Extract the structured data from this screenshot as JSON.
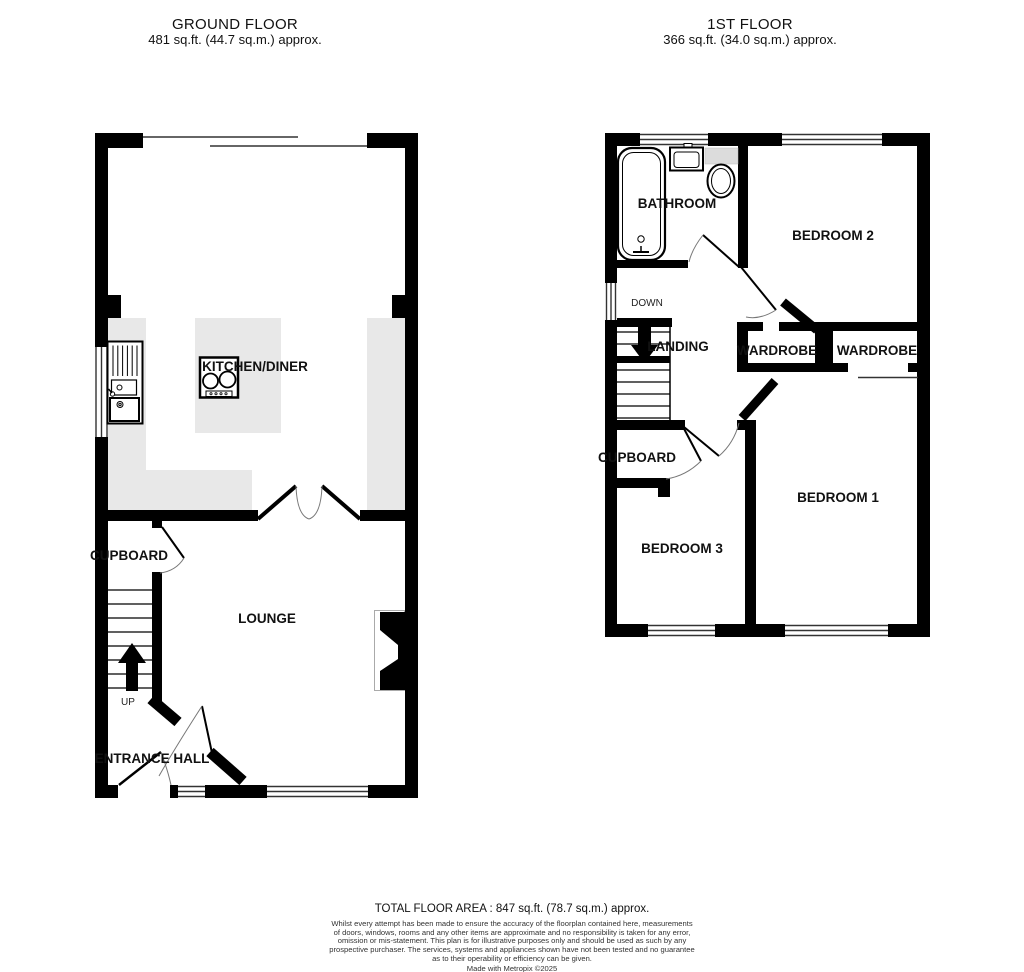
{
  "ground_floor": {
    "title": "GROUND FLOOR",
    "area": "481 sq.ft. (44.7 sq.m.) approx.",
    "labels": {
      "kitchen_diner": "KITCHEN/DINER",
      "cupboard": "CUPBOARD",
      "lounge": "LOUNGE",
      "up": "UP",
      "entrance_hall": "ENTRANCE HALL"
    }
  },
  "first_floor": {
    "title": "1ST FLOOR",
    "area": "366 sq.ft. (34.0 sq.m.) approx.",
    "labels": {
      "bathroom": "BATHROOM",
      "bedroom2": "BEDROOM 2",
      "down": "DOWN",
      "landing": "LANDING",
      "wardrobe_left": "WARDROBE",
      "wardrobe_right": "WARDROBE",
      "cupboard": "CUPBOARD",
      "bedroom3": "BEDROOM 3",
      "bedroom1": "BEDROOM 1"
    }
  },
  "footer": {
    "total_area": "TOTAL FLOOR AREA : 847 sq.ft. (78.7 sq.m.) approx.",
    "disclaimer_lines": [
      "Whilst every attempt has been made to ensure the accuracy of the floorplan contained here, measurements",
      "of doors, windows, rooms and any other items are approximate and no responsibility is taken for any error,",
      "omission or mis-statement. This plan is for illustrative purposes only and should be used as such by any",
      "prospective purchaser. The services, systems and appliances shown have not been tested and no guarantee",
      "as to their operability or efficiency can be given."
    ],
    "credit": "Made with Metropix ©2025"
  },
  "colors": {
    "wall": "#000000",
    "counter": "#e8e8e8",
    "fixture_gray": "#dcdcdc",
    "arc": "#777777"
  }
}
